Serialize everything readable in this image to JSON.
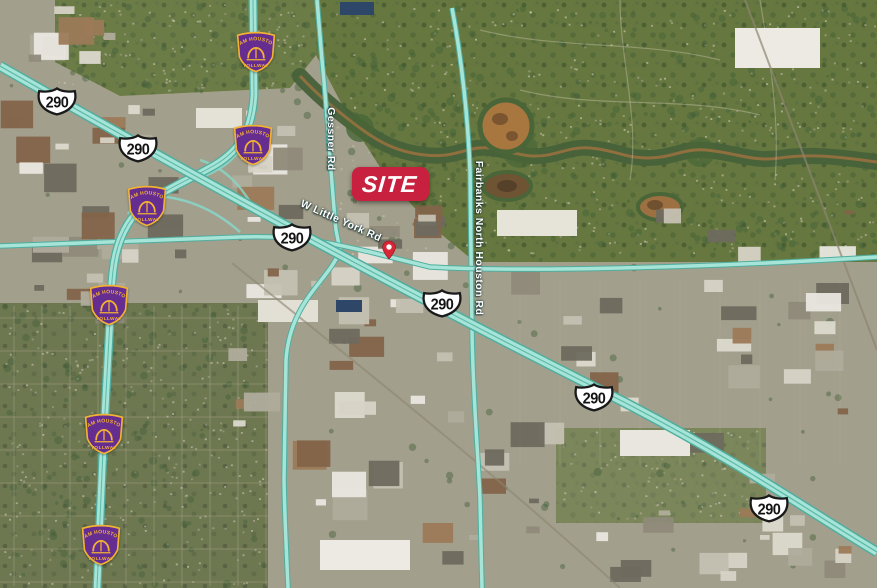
{
  "site_marker": {
    "label": "SITE",
    "color": "#c8203f",
    "text_color": "#ffffff",
    "x": 352,
    "y": 167,
    "width": 77,
    "height": 34
  },
  "location_pin": {
    "color": "#d92637",
    "x": 389,
    "y": 246
  },
  "streets": [
    {
      "name": "Gessner Rd",
      "x": 331,
      "y": 139,
      "rotation": 90
    },
    {
      "name": "W Little York Rd",
      "x": 341,
      "y": 221,
      "rotation": 24
    },
    {
      "name": "Fairbanks North Houston Rd",
      "x": 479,
      "y": 238,
      "rotation": 90
    }
  ],
  "us_highway_shields": {
    "route": "290",
    "positions": [
      {
        "x": 57,
        "y": 101
      },
      {
        "x": 138,
        "y": 148
      },
      {
        "x": 292,
        "y": 237
      },
      {
        "x": 442,
        "y": 303
      },
      {
        "x": 594,
        "y": 397
      },
      {
        "x": 769,
        "y": 508
      }
    ]
  },
  "tollway_shields": {
    "top_text": "SAM HOUSTON",
    "bottom_text": "TOLLWAY",
    "color": "#662d91",
    "accent": "#f2b233",
    "positions": [
      {
        "x": 256,
        "y": 50
      },
      {
        "x": 253,
        "y": 143
      },
      {
        "x": 147,
        "y": 204
      },
      {
        "x": 109,
        "y": 303
      },
      {
        "x": 104,
        "y": 432
      },
      {
        "x": 101,
        "y": 543
      }
    ]
  },
  "colors": {
    "road_highlight": "#a7e4d8",
    "road_casing": "#4fae9f",
    "creek": "#97713f",
    "greenbelt": "#47613a"
  }
}
